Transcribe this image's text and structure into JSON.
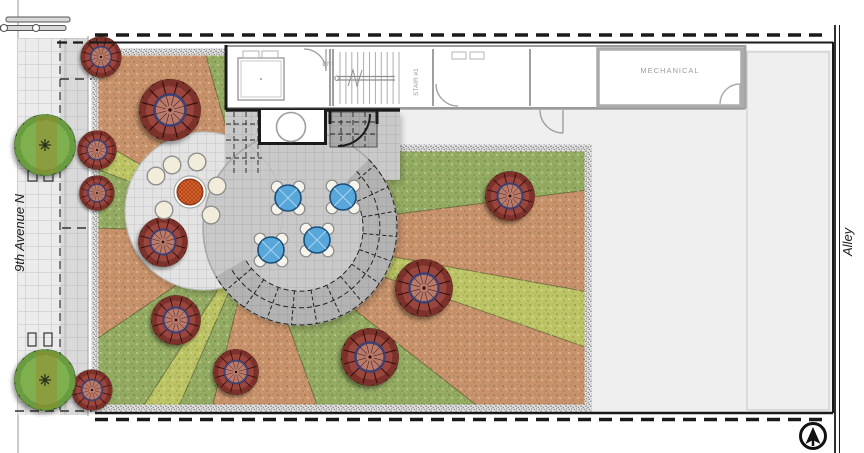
{
  "title": "Rooftop Garden Site Plan",
  "labels": {
    "street": "9th Avenue N",
    "alley": "Alley",
    "stair": "STAIR #1",
    "stair_dn": "DN",
    "mechanical": "MECHANICAL"
  },
  "colors": {
    "grass_green": "#94ab62",
    "light_green": "#bcc464",
    "planting_orange": "#c8926a",
    "tree_canopy_red": "#9a453d",
    "street_tree_green": "#7fb050",
    "table_blue": "#58a7db",
    "fire_pit_orange": "#e2652c",
    "paving_light": "#e3e3e3",
    "paving_mid": "#c9c9c9",
    "roof_gray": "#efeff0",
    "line_black": "#1a1a1a"
  }
}
